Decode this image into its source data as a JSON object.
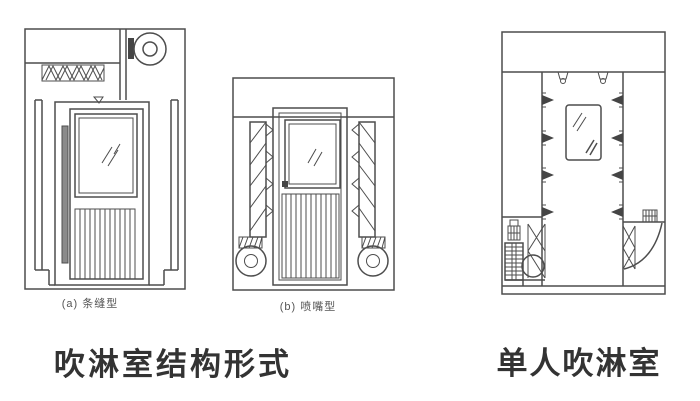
{
  "page": {
    "background": "#ffffff",
    "line_color": "#4d4d4d",
    "caption_color": "#333333"
  },
  "figures": {
    "slot": {
      "label": "(a) 条缝型"
    },
    "nozzle": {
      "label": "(b) 喷嘴型"
    }
  },
  "captions": {
    "structure": "吹淋室结构形式",
    "single": "单人吹淋室"
  }
}
